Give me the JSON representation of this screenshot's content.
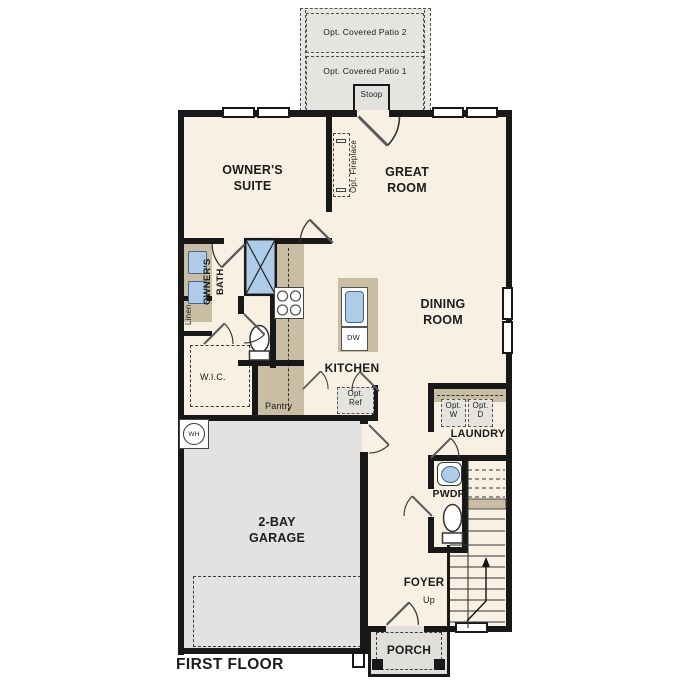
{
  "plan_title": "FIRST FLOOR",
  "labels": {
    "patio2": "Opt. Covered Patio 2",
    "patio1": "Opt. Covered Patio 1",
    "stoop": "Stoop",
    "owners_suite": "OWNER'S SUITE",
    "great_room": "GREAT ROOM",
    "opt_fireplace": "Opt. Fireplace",
    "owners_bath": "OWNER'S\nBATH",
    "linen": "Linen",
    "wic": "W.I.C.",
    "kitchen": "KITCHEN",
    "pantry": "Pantry",
    "opt_ref": "Opt.\nRef",
    "dining_room": "DINING ROOM",
    "opt_w": "Opt.\nW",
    "opt_d": "Opt.\nD",
    "laundry": "LAUNDRY",
    "pwdr": "PWDR",
    "wh": "WH",
    "dw": "DW",
    "garage": "2-BAY GARAGE",
    "foyer": "FOYER",
    "up": "Up",
    "porch": "PORCH",
    "first_floor": "FIRST FLOOR"
  },
  "colors": {
    "wall": "#181818",
    "floor": "#f8f0e3",
    "garage_floor": "#e3e2e0",
    "porch_patio": "#e5e4e1",
    "counter_tan": "#c9bda4",
    "fixture_blue": "#aecbe8"
  }
}
